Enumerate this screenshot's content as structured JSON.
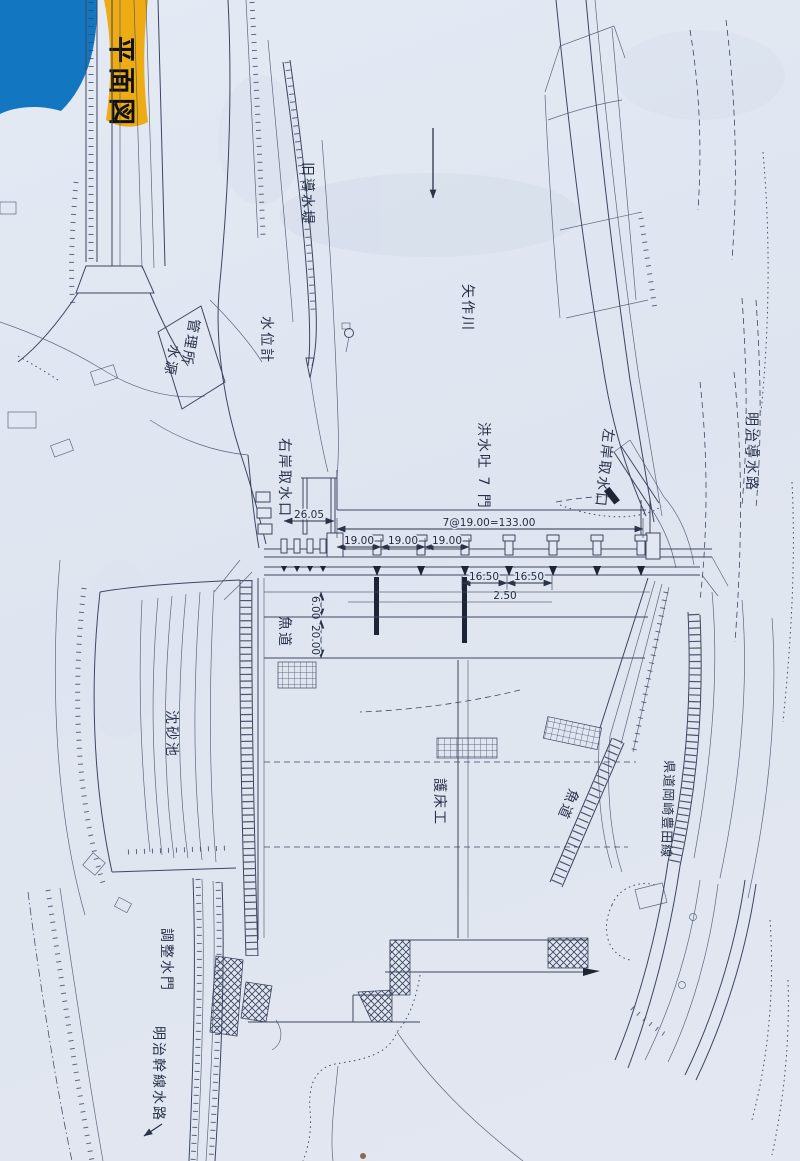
{
  "title": {
    "tag": "平面図"
  },
  "colors": {
    "paper": "#e1e7f1",
    "ink": "#3c4660",
    "blue_corner": "#1277c0",
    "yellow_tag": "#eeac14",
    "tag_text": "#101010"
  },
  "labels": {
    "old_dike": "旧導水堤",
    "water_level_gauge": "水位計",
    "office_line1": "水源",
    "office_line2": "管理所",
    "yahagi_river": "矢作川",
    "flood_gates": "洪水吐 7 門",
    "right_bank_intake": "右岸取水口",
    "left_bank_intake": "左岸取水口",
    "meiji_conduit": "明治導水路",
    "fishway_left": "魚道",
    "fishway_right": "魚道",
    "settling_basin": "沈砂池",
    "bed_protection": "護床工",
    "pref_road": "県道岡崎豊田線",
    "regulating_gate": "調整水門",
    "meiji_main_canal": "明治幹線水路"
  },
  "dimensions": {
    "intake_width": "26.05",
    "total_span": "7@19.00=133.00",
    "gate_span_1": "19.00",
    "gate_span_2": "19.00",
    "gate_span_3": "19.00",
    "half_span_1": "16.50",
    "half_span_2": "16.50",
    "pier_width": "2.50",
    "apron_depth_1": "6.00",
    "apron_depth_2": "20.00"
  }
}
